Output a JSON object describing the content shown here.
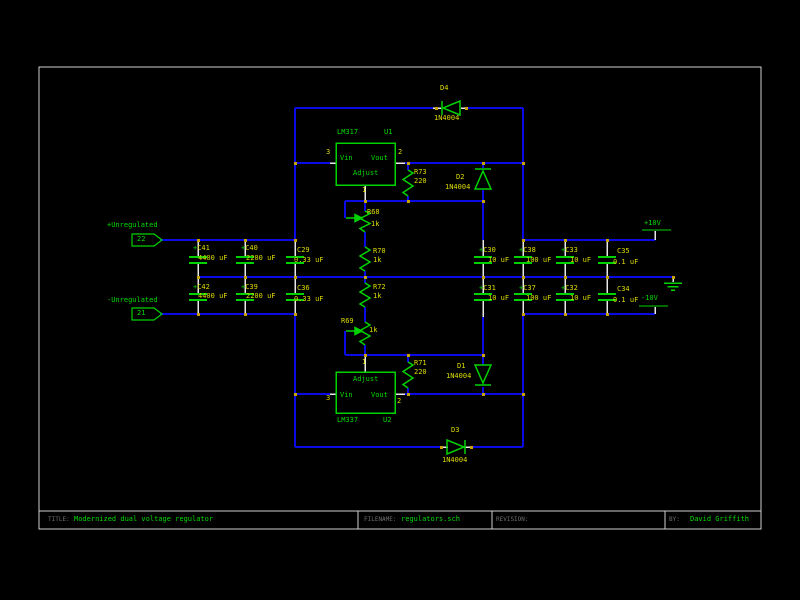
{
  "schematic": {
    "title_block": {
      "title_label": "TITLE:",
      "title": "Modernized dual voltage regulator",
      "filename_label": "FILENAME:",
      "filename": "regulators.sch",
      "revision_label": "REVISION:",
      "by_label": "BY:",
      "by": "David Griffith"
    },
    "inputs": {
      "pos_label": "+Unregulated",
      "pos_pin": "22",
      "neg_label": "-Unregulated",
      "neg_pin": "21"
    },
    "outputs": {
      "pos": "+10V",
      "neg": "-10V"
    },
    "u1": {
      "part": "LM317",
      "ref": "U1",
      "vin": "Vin",
      "vout": "Vout",
      "adj": "Adjust",
      "pin_vin": "3",
      "pin_vout": "2",
      "pin_adj": "1"
    },
    "u2": {
      "part": "LM337",
      "ref": "U2",
      "vin": "Vin",
      "vout": "Vout",
      "adj": "Adjust",
      "pin_vin": "3",
      "pin_vout": "2",
      "pin_adj": "1"
    },
    "diodes": {
      "d4": {
        "ref": "D4",
        "value": "1N4004"
      },
      "d2": {
        "ref": "D2",
        "value": "1N4004"
      },
      "d1": {
        "ref": "D1",
        "value": "1N4004"
      },
      "d3": {
        "ref": "D3",
        "value": "1N4004"
      }
    },
    "resistors": {
      "r73": {
        "ref": "R73",
        "value": "220"
      },
      "r71": {
        "ref": "R71",
        "value": "220"
      },
      "r68": {
        "ref": "R68",
        "value": "1k"
      },
      "r70": {
        "ref": "R70",
        "value": "1k"
      },
      "r72": {
        "ref": "R72",
        "value": "1k"
      },
      "r69": {
        "ref": "R69",
        "value": "1k"
      }
    },
    "capacitors": {
      "c41": {
        "plus": "+",
        "ref": "C41",
        "value": "4400 uF"
      },
      "c40": {
        "plus": "+",
        "ref": "C40",
        "value": "2200 uF"
      },
      "c29": {
        "ref": "C29",
        "value": "0.33 uF"
      },
      "c42": {
        "plus": "+",
        "ref": "C42",
        "value": "4400 uF"
      },
      "c39": {
        "plus": "+",
        "ref": "C39",
        "value": "2200 uF"
      },
      "c36": {
        "ref": "C36",
        "value": "0.33 uF"
      },
      "c30": {
        "plus": "+",
        "ref": "C30",
        "value": "10 uF"
      },
      "c38": {
        "plus": "+",
        "ref": "C38",
        "value": "100 uF"
      },
      "c33": {
        "plus": "+",
        "ref": "C33",
        "value": "10 uF"
      },
      "c35": {
        "ref": "C35",
        "value": "0.1 uF"
      },
      "c31": {
        "plus": "+",
        "ref": "C31",
        "value": "10 uF"
      },
      "c37": {
        "plus": "+",
        "ref": "C37",
        "value": "100 uF"
      },
      "c32": {
        "plus": "+",
        "ref": "C32",
        "value": "10 uF"
      },
      "c34": {
        "ref": "C34",
        "value": "0.1 uF"
      }
    },
    "colors": {
      "background": "#000000",
      "wire": "#0A0AE6",
      "component": "#00D200",
      "label": "#DCDC00",
      "net_label": "#00DC00",
      "pin": "#E8E8E8",
      "border": "#D0D0D0",
      "junction": "#C8A000"
    }
  }
}
